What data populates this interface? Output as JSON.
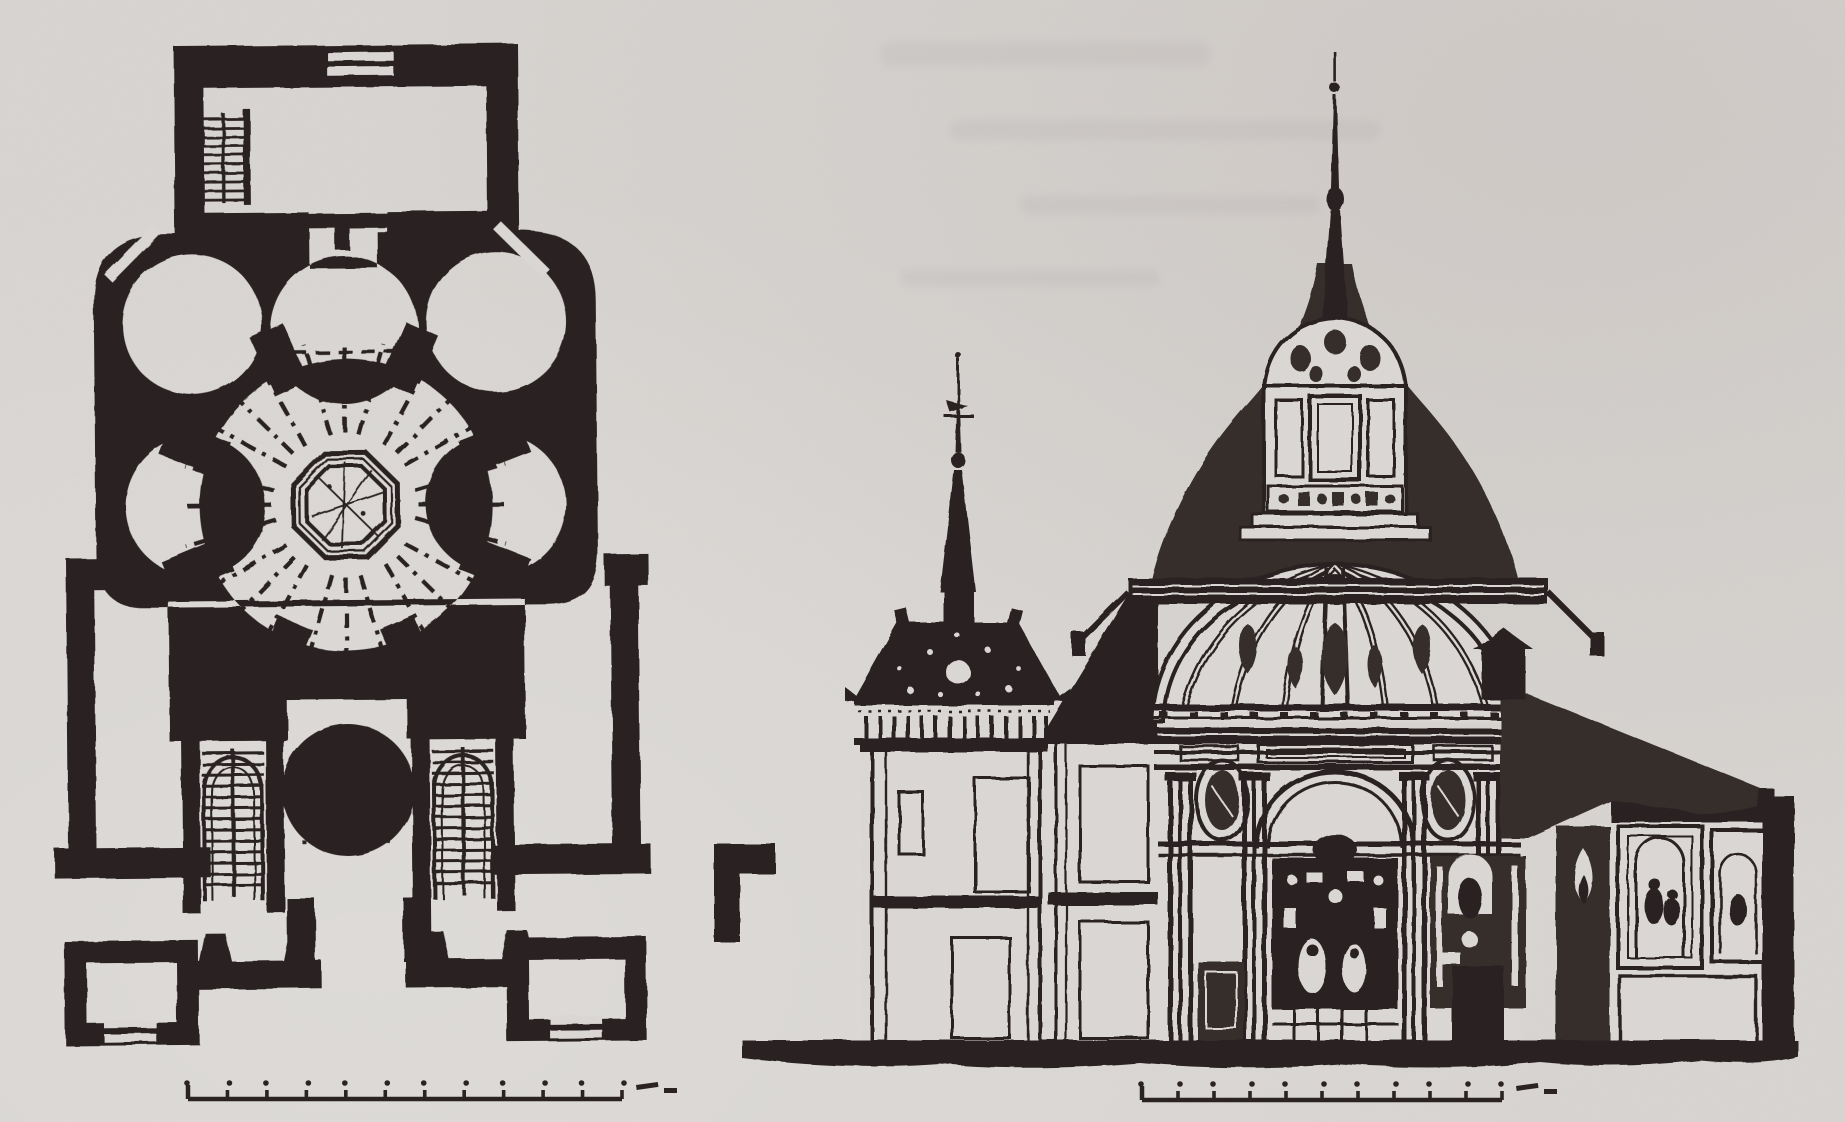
{
  "document": {
    "kind": "scanned architectural figure",
    "description": "Black ink drawing on grey paper: floor plan of a centralized Baroque church (left) and longitudinal cross-section (right)",
    "colors": {
      "paper": "#d9d6d3",
      "ink": "#2b2321",
      "ink_soft": "#362d2a"
    },
    "figures": {
      "plan": {
        "label": "floor plan with octagonal crossing, radiating circular chapels, twin staircases and entrance pavilions"
      },
      "section": {
        "label": "cross-section with ribbed dome, lantern and slate spire, left bell tower and side chapel wing with altarpieces"
      }
    },
    "scale_bars": [
      {
        "id": "plan-scale",
        "x1": 188,
        "x2": 622,
        "y": 1099,
        "ticks": 12,
        "end_dash": true
      },
      {
        "id": "section-scale",
        "x1": 1142,
        "x2": 1502,
        "y": 1100,
        "ticks": 11,
        "end_dash": true
      }
    ]
  }
}
